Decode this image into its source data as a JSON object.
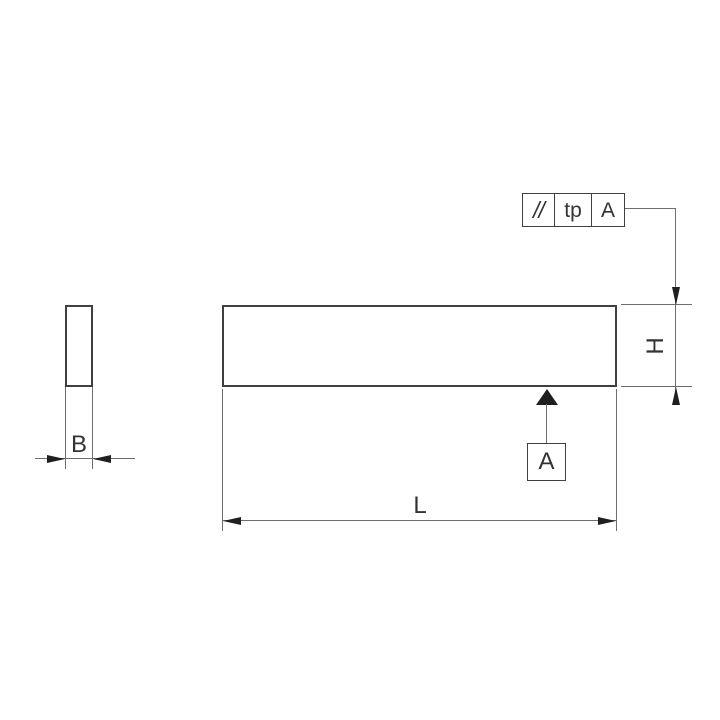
{
  "feature_control_frame": {
    "parallelism_symbol": "//",
    "tolerance": "tp",
    "datum_reference": "A"
  },
  "datum": {
    "label": "A"
  },
  "dimensions": {
    "width_label": "B",
    "height_label": "H",
    "length_label": "L"
  },
  "colors": {
    "background": "#ffffff",
    "object_line": "#3f3f3f",
    "thin_line": "#6e6e6e",
    "arrow": "#1f1f1f",
    "text": "#333333"
  }
}
